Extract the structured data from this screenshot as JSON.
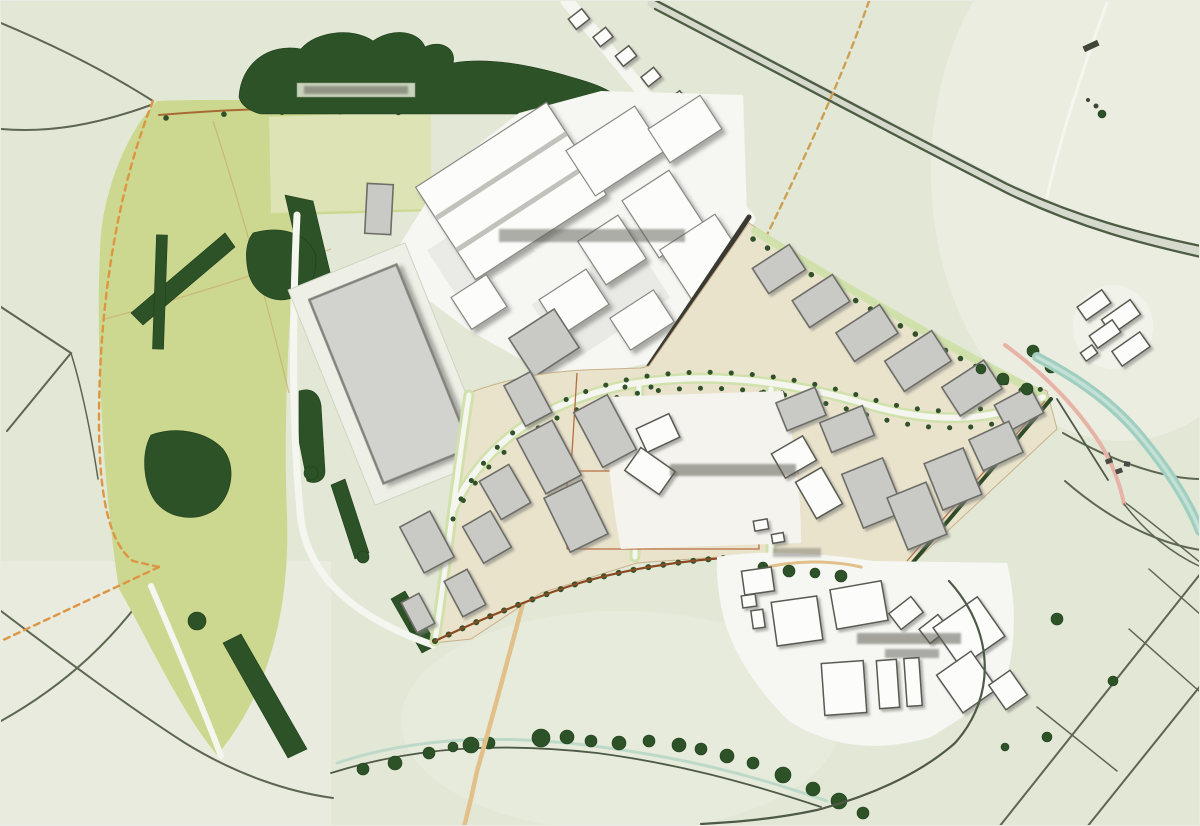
{
  "map": {
    "kind": "development-site-masterplan",
    "labels": {
      "woodland_plate": {
        "text": "",
        "illegible": true
      },
      "industrial_estate": {
        "text": "",
        "illegible": true
      },
      "mid_site": {
        "text": "",
        "illegible": true
      },
      "mid_site_small": {
        "text": "",
        "illegible": true
      },
      "southeast_estate_line1": {
        "text": "",
        "illegible": true
      },
      "southeast_estate_line2": {
        "text": "",
        "illegible": true
      }
    }
  },
  "colors": {
    "bg": "#e3e8d5",
    "bgLight": "#eef0e4",
    "field": "#ccd88c",
    "fieldPale": "#dde3b2",
    "forest": "#2c5226",
    "forestDark": "#1e3d1a",
    "treeDot": "#2f5128",
    "laneLine": "#5c6650",
    "roadWhite": "#f6f6f1",
    "mainRoadEdge": "#4d5c42",
    "mainRoadFill": "#d6dacd",
    "boundaryOrange": "#e0953f",
    "pathTan": "#e2c088",
    "estateWhite": "#f6f6f2",
    "buildingWhite": "#fcfcfa",
    "buildingGray": "#c9c9c6",
    "buildingStroke": "#6e6e68",
    "darkEdge": "#3a3a33",
    "plotBeige": "#eae3cb",
    "plotLine": "#b05a28",
    "verge": "#cfe0a8",
    "river": "#9fcfc2",
    "pinkRoad": "#e9b3a6",
    "streamTeal": "#bcd9c9",
    "labelSmudge": "#5e5e58"
  }
}
